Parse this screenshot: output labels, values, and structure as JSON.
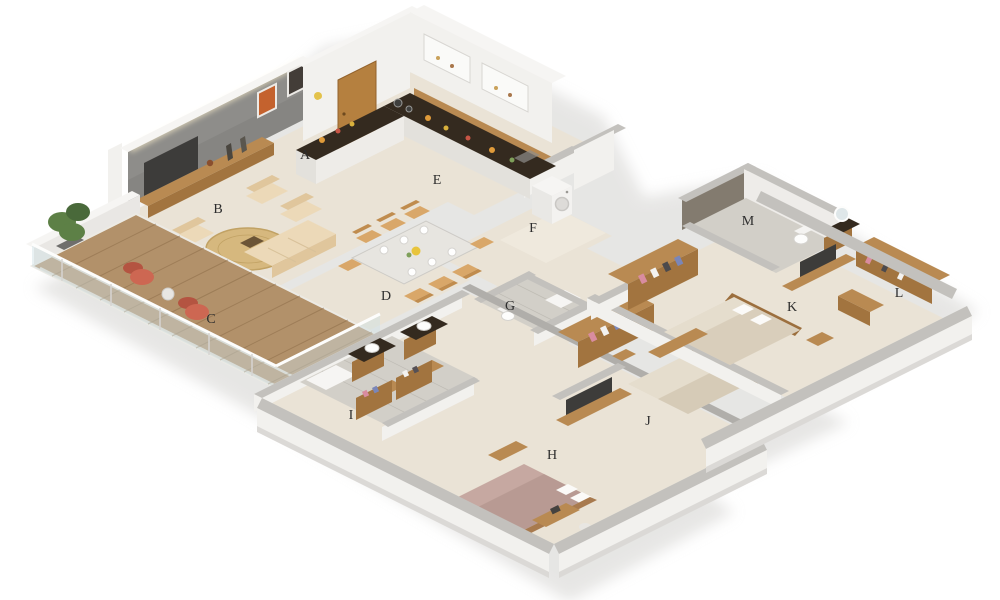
{
  "scene": {
    "kind": "isometric-3d-floorplan-render",
    "width": 1000,
    "height": 600,
    "background": "#ffffff"
  },
  "room_labels": [
    {
      "letter": "A",
      "x": 305,
      "y": 156,
      "area": "kitchen-entry"
    },
    {
      "letter": "B",
      "x": 218,
      "y": 210,
      "area": "living-room"
    },
    {
      "letter": "C",
      "x": 211,
      "y": 320,
      "area": "balcony-deck"
    },
    {
      "letter": "D",
      "x": 386,
      "y": 297,
      "area": "dining-area"
    },
    {
      "letter": "E",
      "x": 437,
      "y": 181,
      "area": "kitchen"
    },
    {
      "letter": "F",
      "x": 533,
      "y": 229,
      "area": "utility"
    },
    {
      "letter": "G",
      "x": 510,
      "y": 307,
      "area": "common-bathroom"
    },
    {
      "letter": "H",
      "x": 552,
      "y": 456,
      "area": "bedroom-lower"
    },
    {
      "letter": "I",
      "x": 351,
      "y": 416,
      "area": "master-bathroom"
    },
    {
      "letter": "J",
      "x": 648,
      "y": 422,
      "area": "bedroom-middle"
    },
    {
      "letter": "K",
      "x": 792,
      "y": 308,
      "area": "bedroom-right"
    },
    {
      "letter": "L",
      "x": 899,
      "y": 294,
      "area": "dressing-area"
    },
    {
      "letter": "M",
      "x": 748,
      "y": 222,
      "area": "bathroom-right"
    }
  ],
  "label_style": {
    "color": "#2d2d2d",
    "font_size": 14
  },
  "palette": {
    "bg": "#ffffff",
    "floor": "#eae3d6",
    "floor_light": "#efe9dd",
    "tile": "#d2cfc8",
    "tile_dark": "#bfbcb5",
    "wall_cap": "#c3c1bd",
    "wall_cap_dark": "#b0aeaa",
    "wall_face": "#f2f1ee",
    "wall_shade": "#e3e1dc",
    "feature_wall": "#8e8d8a",
    "wood": "#b98a52",
    "wood_dark": "#a2743f",
    "wood_deep": "#8a6a46",
    "deck": "#b2916a",
    "counter": "#342a1f",
    "sofa": "#ecd9b8",
    "sofa_shade": "#e0c69c",
    "rug": "#d6b87e",
    "chair_red": "#cd6752",
    "plant": "#5d8046",
    "plant_dark": "#49693a",
    "tv": "#3d3c3a",
    "bed": "#e5ddcd",
    "bed_shade": "#d6cbb7",
    "bed_mauve": "#c6a8a1",
    "bed_mauve_shade": "#b2948d",
    "glass": "#cfe0e4",
    "white": "#f6f5f3",
    "label": "#2d2d2d"
  }
}
